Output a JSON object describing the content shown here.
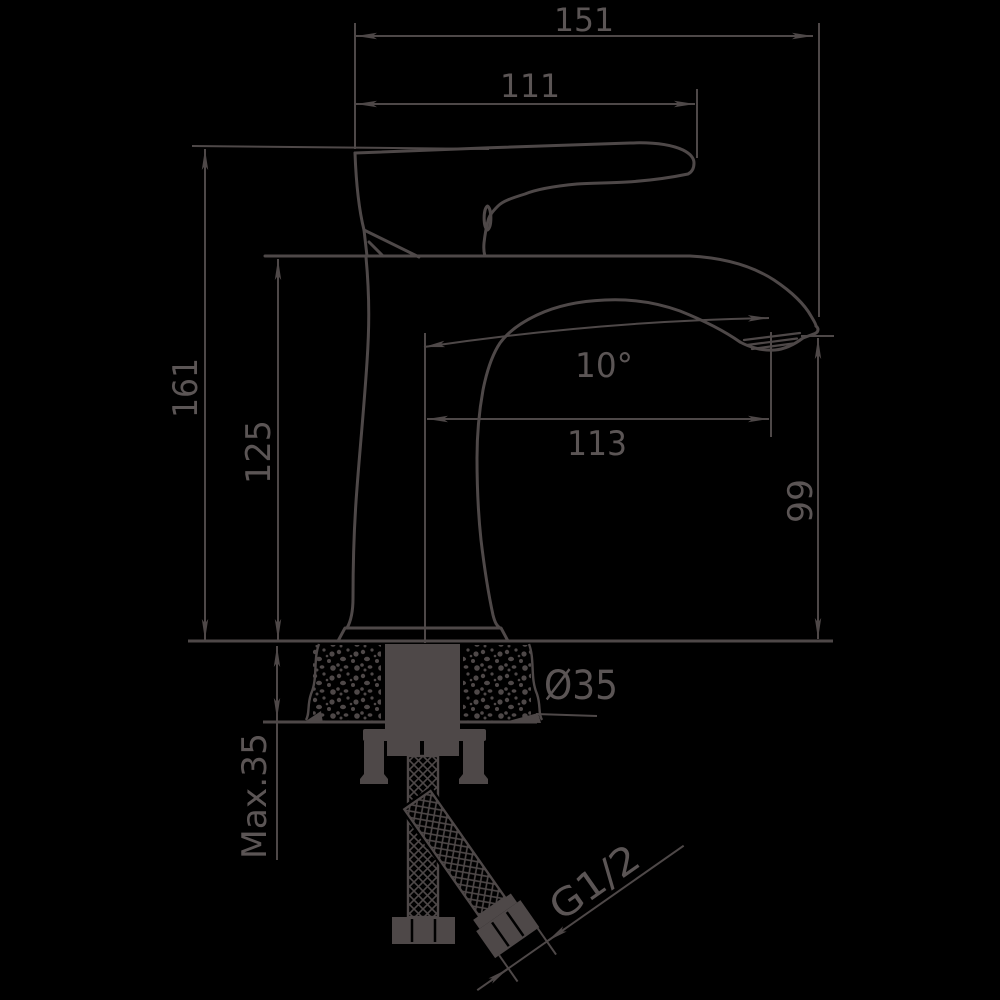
{
  "page": {
    "background": "#000000"
  },
  "drawing": {
    "type": "faucet-installation-dimension-diagram",
    "colors": {
      "line": "#4e4848",
      "text": "#5b5555",
      "background": "#000000"
    },
    "labels": {
      "overall_width": "151",
      "spout_top_width": "111",
      "overall_height": "161",
      "body_height": "125",
      "spout_angle": "10°",
      "spout_reach": "113",
      "spout_outlet_height": "99",
      "mounting_hole_diameter": "Ø35",
      "max_counter_thickness": "Max.35",
      "connection_thread": "G1/2"
    }
  }
}
